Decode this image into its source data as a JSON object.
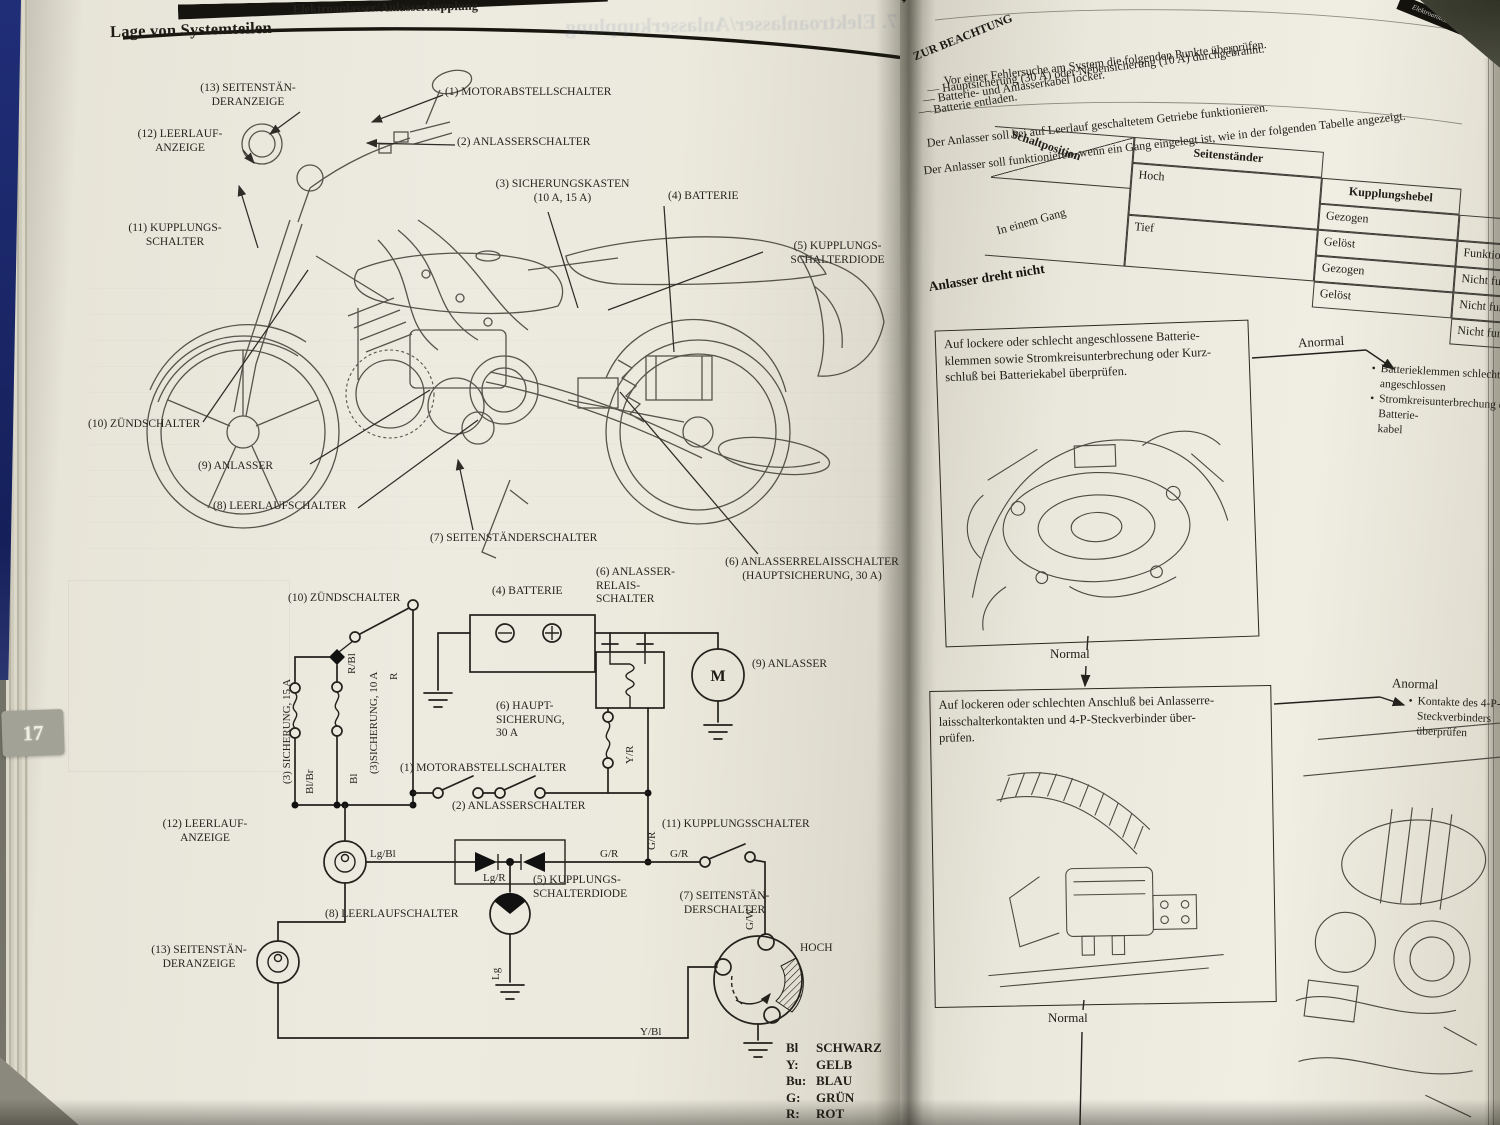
{
  "book": {
    "tab_number": "17",
    "left_page": {
      "chapter_header": "Elektroanlasser/Anlasserkupplung",
      "title": "Lage von Systemteilen",
      "ghost_title": "17. Elektroanlasser/Anlasserkupplung",
      "motor_symbol": "M",
      "moto_labels": [
        "(13) SEITENSTÄN-\nDERANZEIGE",
        "(12) LEERLAUF-\nANZEIGE",
        "(11) KUPPLUNGS-\nSCHALTER",
        "(1) MOTORABSTELLSCHALTER",
        "(2) ANLASSERSCHALTER",
        "(3) SICHERUNGSKASTEN\n(10 A, 15 A)",
        "(4) BATTERIE",
        "(5) KUPPLUNGS-\nSCHALTERDIODE",
        "(10) ZÜNDSCHALTER",
        "(9) ANLASSER",
        "(8) LEERLAUFSCHALTER",
        "(7) SEITENSTÄNDERSCHALTER",
        "(6) ANLASSERRELAISSCHALTER\n(HAUPTSICHERUNG, 30 A)"
      ],
      "schematic_labels": [
        "(10) ZÜNDSCHALTER",
        "(4) BATTERIE",
        "(6) ANLASSER-\nRELAIS-\nSCHALTER",
        "(9) ANLASSER",
        "(6) HAUPT-\nSICHERUNG,\n30 A",
        "(1) MOTORABSTELLSCHALTER",
        "(2) ANLASSERSCHALTER",
        "(12) LEERLAUF-\nANZEIGE",
        "(11) KUPPLUNGSSCHALTER",
        "(5) KUPPLUNGS-\nSCHALTERDIODE",
        "(8) LEERLAUFSCHALTER",
        "(7) SEITENSTÄN-\nDERSCHALTER",
        "HOCH",
        "(13) SEITENSTÄN-\nDERANZEIGE"
      ],
      "wire_labels": [
        "(3) SICHERUNG, 15 A",
        "(3)SICHERUNG, 10 A",
        "R/Bl",
        "R",
        "Bl/Br",
        "Bl",
        "Y/R",
        "Lg/Bl",
        "G/R",
        "G/R",
        "G/R",
        "Lg/R",
        "G/W",
        "Lg",
        "Y/Bl"
      ],
      "legend": [
        [
          "Bl",
          "SCHWARZ"
        ],
        [
          "Y:",
          "GELB"
        ],
        [
          "Bu:",
          "BLAU"
        ],
        [
          "G:",
          "GRÜN"
        ],
        [
          "R:",
          "ROT"
        ]
      ]
    },
    "right_page": {
      "chapter_header": "Elektroanlasser/Anlasserkupplung",
      "section_heading": "Fehlersuche",
      "caution_label": "ZUR BEACHTUNG",
      "caution_intro": "Vor einer Fehlersuche am System die folgenden Punkte überprüfen.",
      "caution_items": [
        "— Hauptsicherung (30 A) oder Nebensicherung (10 A) durchgebrannt.",
        "— Batterie- und Anlasserkabel locker.",
        "— Batterie entladen."
      ],
      "notes": [
        "Der Anlasser soll bei auf Leerlauf geschaltetem Getriebe funktionieren.",
        "Der Anlasser soll funktionieren, wenn ein Gang eingelegt ist, wie in der folgenden Tabelle angezeigt."
      ],
      "table": {
        "corner_label": "Schaltposition",
        "col_seitenstaender": "Seitenständer",
        "col_kupplungshebel": "Kupplungshebel",
        "col_anlasser": "Anlasser",
        "row_group": "In einem Gang",
        "seitenstaender_values": [
          "Hoch",
          "Tief"
        ],
        "kupplung_values": [
          "Gezogen",
          "Gelöst",
          "Gezogen",
          "Gelöst"
        ],
        "anlasser_values": [
          "Funktioniert",
          "Nicht funktioniert",
          "Nicht funktioniert",
          "Nicht funktioniert"
        ]
      },
      "flow_heading": "Anlasser dreht nicht",
      "steps": [
        {
          "box": "Auf lockere oder schlecht angeschlossene Batterie-\nklemmen sowie Stromkreisunterbrechung oder Kurz-\nschluß bei Batteriekabel überprüfen.",
          "anormal": "Anormal",
          "results": [
            "Batterieklemmen schlecht angeschlossen",
            "Stromkreisunterbrechung der Batterie-\nkabel"
          ],
          "normal": "Normal"
        },
        {
          "box": "Auf lockeren oder schlechten Anschluß bei Anlasserre-\nlaisschalterkontakten und 4-P-Steckverbinder über-\nprüfen.",
          "anormal": "Anormal",
          "results": [
            "Kontakte des 4-P-Steckverbinders überprüfen"
          ],
          "normal": "Normal"
        }
      ]
    }
  }
}
